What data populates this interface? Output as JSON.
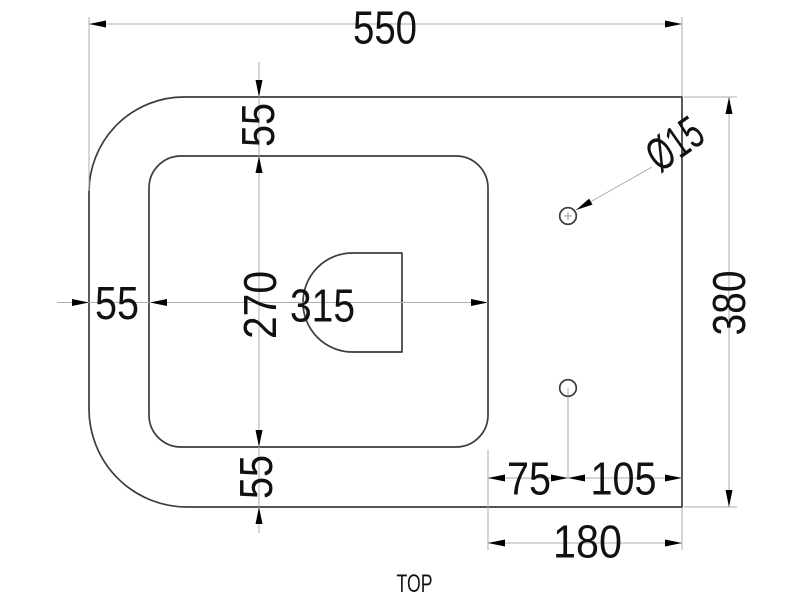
{
  "view_label": "TOP",
  "dims": {
    "overall_width": "550",
    "overall_depth": "380",
    "edge_to_opening_top": "55",
    "edge_to_opening_left": "55",
    "edge_to_opening_bottom": "55",
    "opening_width": "315",
    "opening_depth": "270",
    "hole_diameter": "Ø15",
    "opening_to_hole": "75",
    "hole_to_right_edge": "105",
    "opening_to_right_edge": "180"
  },
  "colors": {
    "outline": "#3c3c3c",
    "dimension_line": "#adadad",
    "arrow": "#000000",
    "text": "#111111",
    "background": "#ffffff"
  }
}
